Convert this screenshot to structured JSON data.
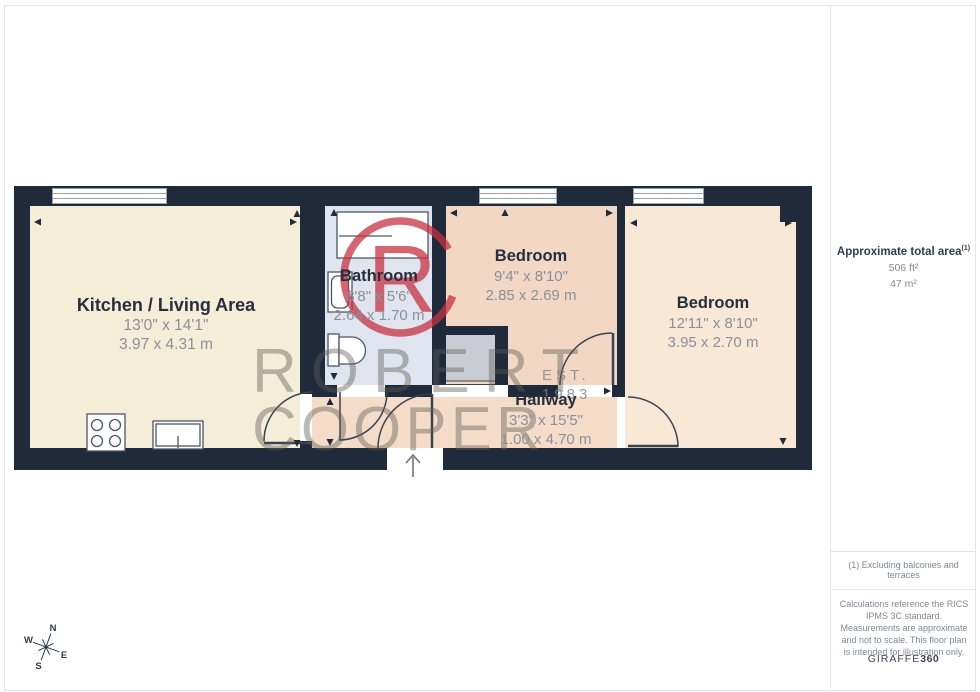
{
  "floorplan": {
    "rooms": [
      {
        "name": "Kitchen / Living Area",
        "imperial": "13'0\" x 14'1\"",
        "metric": "3.97 x 4.31 m"
      },
      {
        "name": "Bathroom",
        "imperial": "8'8\" x 5'6\"",
        "metric": "2.64 x 1.70 m"
      },
      {
        "name": "Bedroom",
        "imperial": "9'4\" x 8'10\"",
        "metric": "2.85 x 2.69 m"
      },
      {
        "name": "Bedroom",
        "imperial": "12'11\" x 8'10\"",
        "metric": "3.95 x 2.70 m"
      },
      {
        "name": "Hallway",
        "imperial": "3'3\" x 15'5\"",
        "metric": "1.00 x 4.70 m"
      }
    ],
    "watermark": {
      "word1": "ROBERT",
      "word2": "COOPER",
      "est": "EST.",
      "year": "1983",
      "monogram": "R"
    },
    "compass": {
      "north": "N",
      "east": "E",
      "south": "S",
      "west": "W"
    }
  },
  "sidebar": {
    "area": {
      "title": "Approximate total area",
      "footnote_ref": "(1)",
      "sqft": "506 ft²",
      "sqm": "47 m²"
    },
    "footnote": "(1) Excluding balconies and terraces",
    "disclaimer": "Calculations reference the RICS IPMS 3C standard. Measurements are approximate and not to scale. This floor plan is intended for illustration only.",
    "brand": {
      "name": "GIRAFFE",
      "suffix": "360"
    }
  },
  "colors": {
    "wall": "#1f2b3b",
    "kitchen": "#f4edd8",
    "bathroom": "#dfe4ef",
    "bedroom_middle": "#f2d7c4",
    "bedroom_right": "#f9e8d5",
    "hallway": "#f4dcc9",
    "closet": "#c9cdd3",
    "logo_red": "#c63242"
  }
}
